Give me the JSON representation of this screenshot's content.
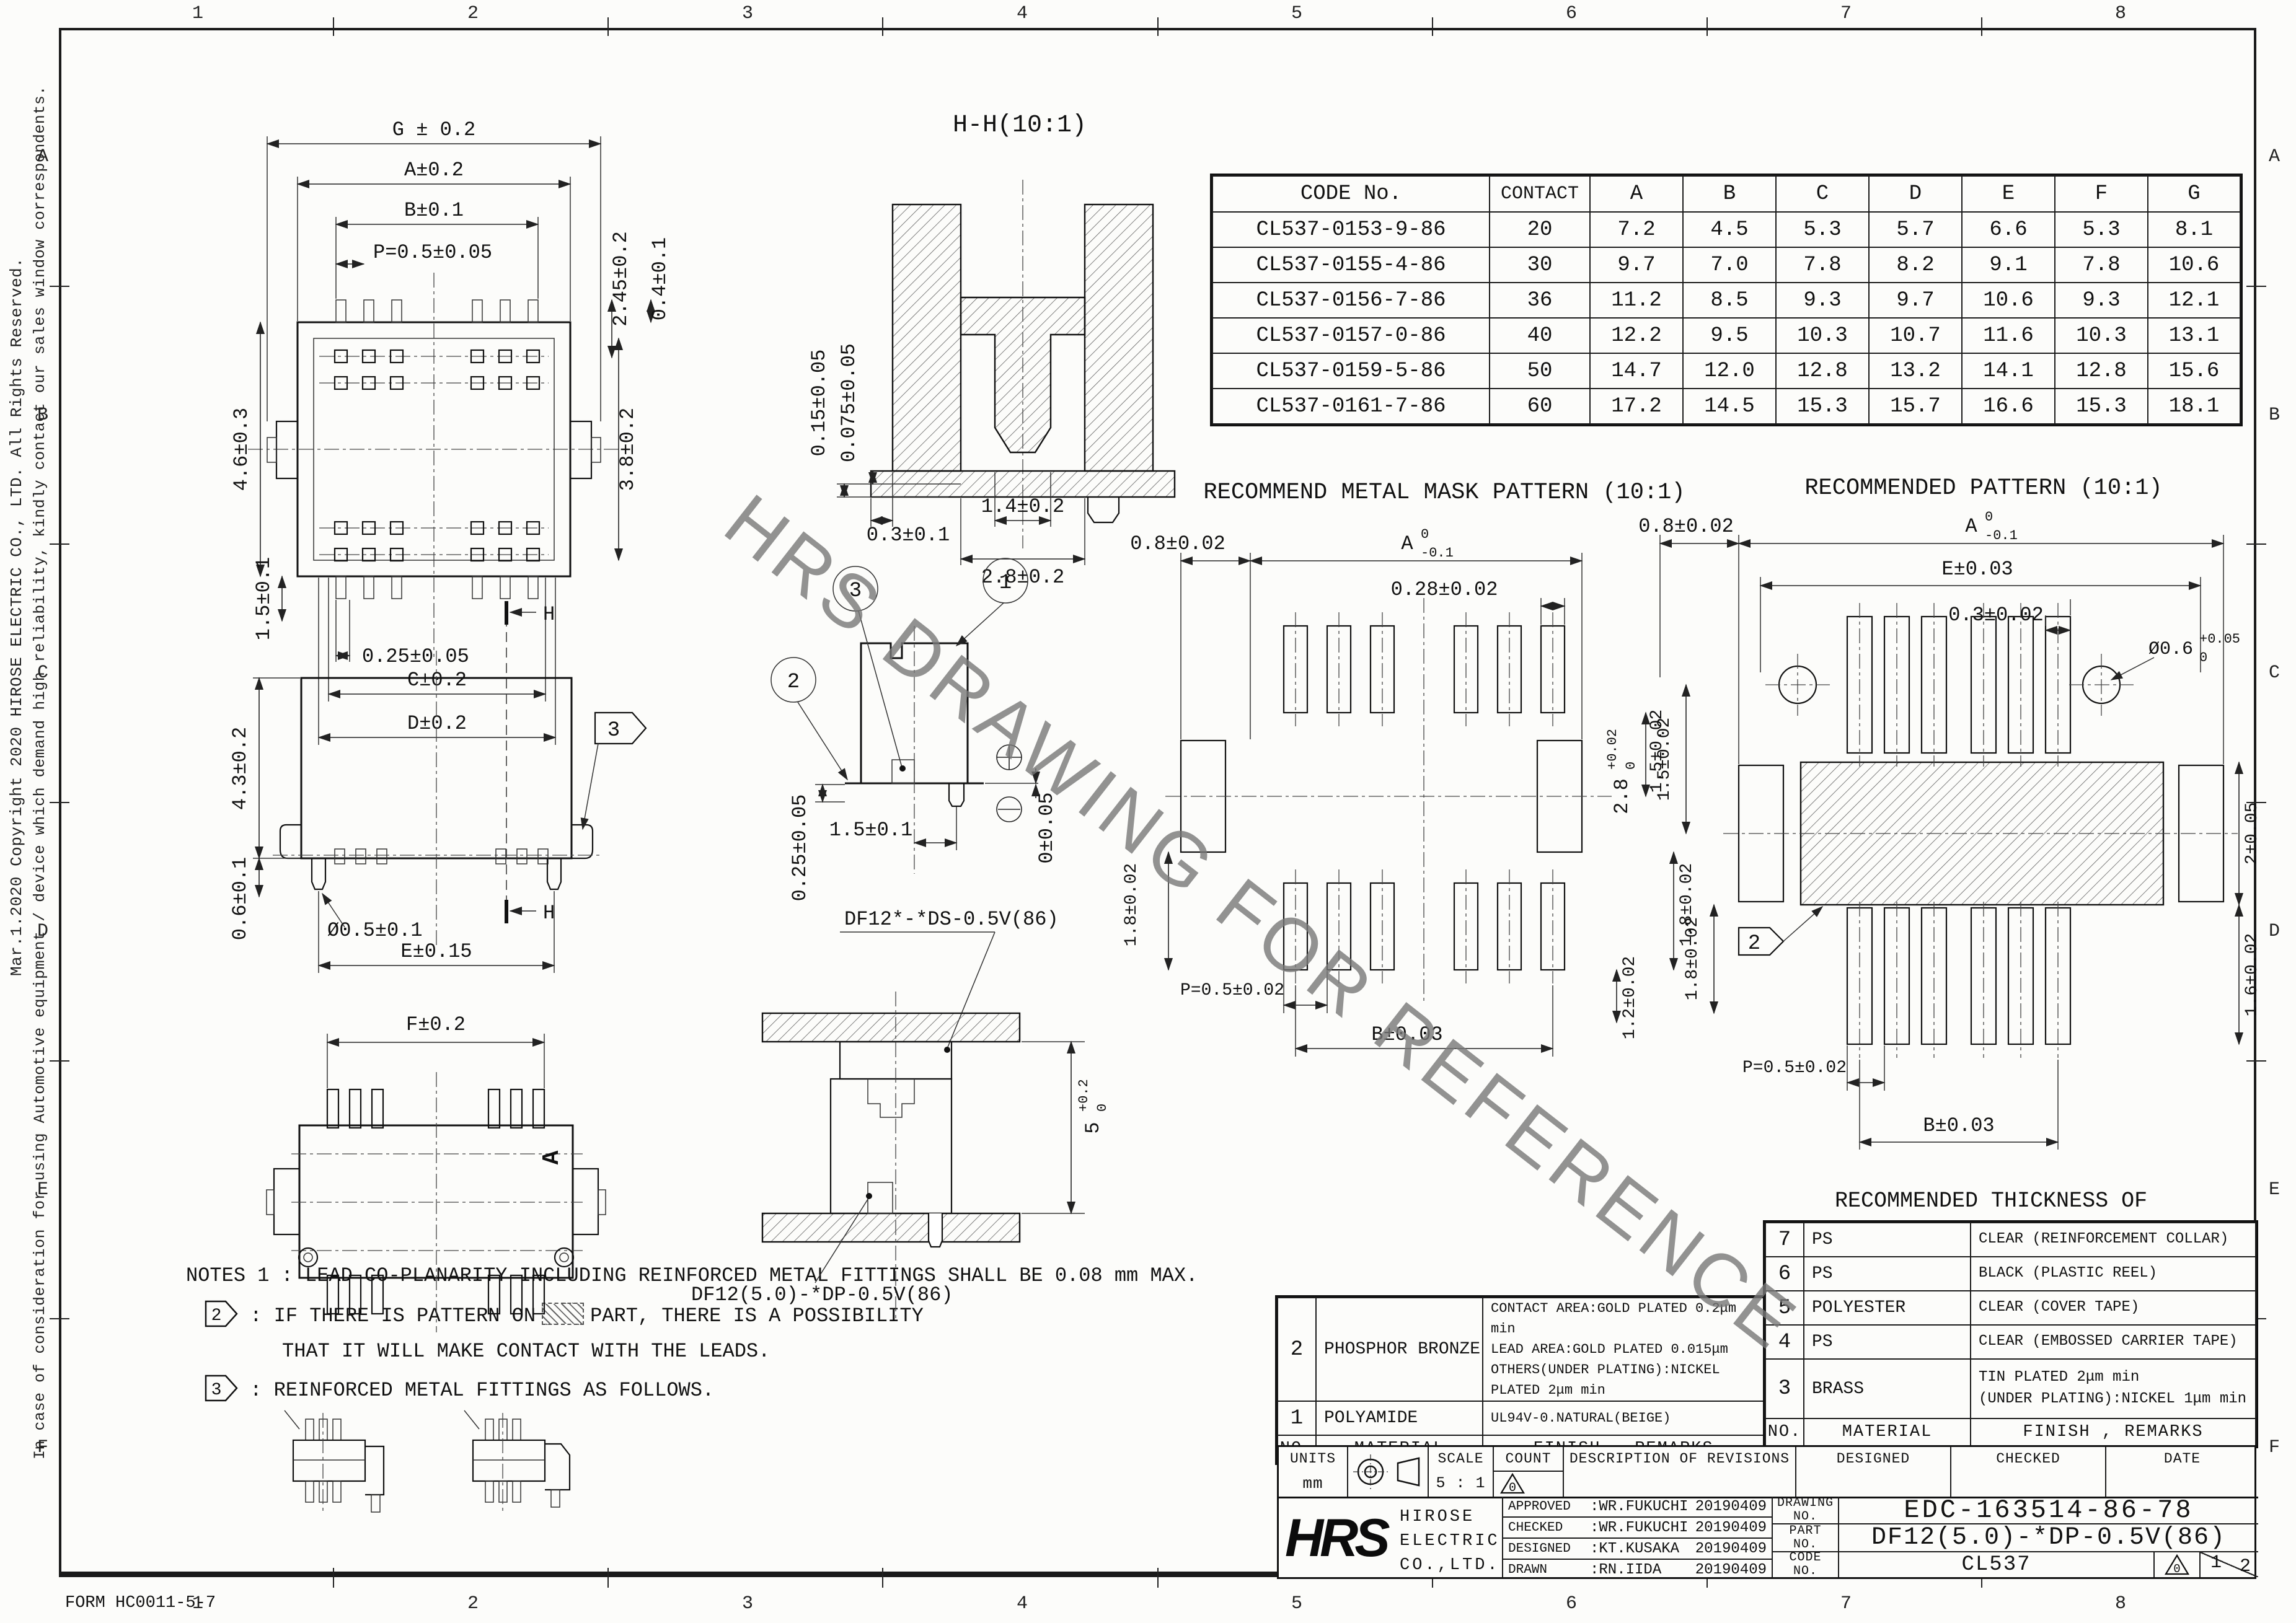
{
  "meta": {
    "watermark": "HRS DRAWING FOR REFERENCE",
    "form_no": "FORM HC0011-5-7",
    "copyright_line": "Mar.1.2020 Copyright 2020 HIROSE ELECTRIC CO., LTD. All Rights Reserved.",
    "caution_line": "In case of consideration for using Automotive equipment / device which demand high reliability, kindly contact our sales window correspondents.",
    "grid_cols": [
      "1",
      "2",
      "3",
      "4",
      "5",
      "6",
      "7",
      "8"
    ],
    "grid_rows": [
      "A",
      "B",
      "C",
      "D",
      "E",
      "F"
    ]
  },
  "code_table": {
    "headers": [
      "CODE No.",
      "CONTACT",
      "A",
      "B",
      "C",
      "D",
      "E",
      "F",
      "G"
    ],
    "rows": [
      [
        "CL537-0153-9-86",
        "20",
        "7.2",
        "4.5",
        "5.3",
        "5.7",
        "6.6",
        "5.3",
        "8.1"
      ],
      [
        "CL537-0155-4-86",
        "30",
        "9.7",
        "7.0",
        "7.8",
        "8.2",
        "9.1",
        "7.8",
        "10.6"
      ],
      [
        "CL537-0156-7-86",
        "36",
        "11.2",
        "8.5",
        "9.3",
        "9.7",
        "10.6",
        "9.3",
        "12.1"
      ],
      [
        "CL537-0157-0-86",
        "40",
        "12.2",
        "9.5",
        "10.3",
        "10.7",
        "11.6",
        "10.3",
        "13.1"
      ],
      [
        "CL537-0159-5-86",
        "50",
        "14.7",
        "12.0",
        "12.8",
        "13.2",
        "14.1",
        "12.8",
        "15.6"
      ],
      [
        "CL537-0161-7-86",
        "60",
        "17.2",
        "14.5",
        "15.3",
        "15.7",
        "16.6",
        "15.3",
        "18.1"
      ]
    ]
  },
  "plan": {
    "dim_g": "G ± 0.2",
    "dim_a": "A±0.2",
    "dim_b": "B±0.1",
    "dim_p": "P=0.5±0.05",
    "dim_245": "2.45±0.2",
    "dim_04": "0.4±0.1",
    "dim_46": "4.6±0.3",
    "dim_38": "3.8±0.2",
    "dim_15": "1.5±0.1",
    "dim_025": "0.25±0.05",
    "dim_c": "C±0.2",
    "dim_d": "D±0.2"
  },
  "section": {
    "title": "H-H(10:1)",
    "dim_015": "0.15±0.05",
    "dim_0075": "0.075±0.05",
    "dim_03": "0.3±0.1",
    "dim_14": "1.4±0.2",
    "dim_28": "2.8±0.2"
  },
  "side": {
    "dim_43": "4.3±0.2",
    "dim_06": "0.6±0.1",
    "dim_dia": "Ø0.5±0.1",
    "dim_e": "E±0.15",
    "h_mark": "H",
    "callout": "3"
  },
  "detail": {
    "b1": "1",
    "b2": "2",
    "b3": "3",
    "dim_025": "0.25±0.05",
    "dim_15": "1.5±0.1",
    "dim_0": "0±0.05"
  },
  "mask": {
    "title": "RECOMMEND METAL MASK PATTERN (10:1)",
    "dim_08": "0.8±0.02",
    "a_base": "A",
    "a_up": "0",
    "a_low": "-0.1",
    "dim_028": "0.28±0.02",
    "dim_15": "1.5±0.02",
    "d28_base": "2.8",
    "d28_up": "+0.02",
    "d28_low": "0",
    "dim_18l": "1.8±0.02",
    "dim_18r": "1.8±0.02",
    "dim_12": "1.2±0.02",
    "dim_p": "P=0.5±0.02",
    "dim_b": "B±0.03"
  },
  "rec": {
    "title": "RECOMMENDED PATTERN (10:1)",
    "dim_08": "0.8±0.02",
    "a_base": "A",
    "a_up": "0",
    "a_low": "-0.1",
    "dim_e": "E±0.03",
    "dim_03": "0.3±0.02",
    "dia_base": "Ø0.6",
    "dia_up": "+0.05",
    "dia_low": "0",
    "dim_2": "2±0.05",
    "dim_16": "1.6±0.02",
    "dim_15": "1.5±0.02",
    "dim_18": "1.8±0.02",
    "dim_p": "P=0.5±0.02",
    "dim_b": "B±0.03",
    "callout": "2",
    "solder1": "RECOMMENDED THICKNESS OF",
    "solder2": "SOLDER PASTE : 120 μm"
  },
  "fview": {
    "dim_f": "F±0.2",
    "marker_a": "A"
  },
  "mated": {
    "label_top": "DF12*-*DS-0.5V(86)",
    "label_bottom": "DF12(5.0)-*DP-0.5V(86)",
    "d5_base": "5",
    "d5_up": "+0.2",
    "d5_low": "0"
  },
  "notes": {
    "line1": "NOTES 1  : LEAD CO-PLANARITY INCLUDING REINFORCED METAL FITTINGS SHALL BE 0.08 mm MAX.",
    "flag2": "2",
    "line2a": ": IF THERE IS PATTERN ON",
    "line2b": "PART, THERE IS A POSSIBILITY",
    "line3": "THAT IT WILL MAKE CONTACT WITH THE LEADS.",
    "flag3": "3",
    "line4": ": REINFORCED METAL FITTINGS AS FOLLOWS."
  },
  "mat_left": {
    "h_no": "NO.",
    "h_mat": "MATERIAL",
    "h_fin": "FINISH , REMARKS",
    "r2_no": "2",
    "r2_mat": "PHOSPHOR BRONZE",
    "r2_f1": "CONTACT AREA:GOLD PLATED 0.2μm min",
    "r2_f2": "LEAD AREA:GOLD PLATED 0.015μm",
    "r2_f3": "OTHERS(UNDER PLATING):NICKEL PLATED 2μm min",
    "r1_no": "1",
    "r1_mat": "POLYAMIDE",
    "r1_f1": "UL94V-0.NATURAL(BEIGE)"
  },
  "mat_right": {
    "h_no": "NO.",
    "h_mat": "MATERIAL",
    "h_fin": "FINISH , REMARKS",
    "r7_no": "7",
    "r7_mat": "PS",
    "r7_f": "CLEAR (REINFORCEMENT COLLAR)",
    "r6_no": "6",
    "r6_mat": "PS",
    "r6_f": "BLACK (PLASTIC REEL)",
    "r5_no": "5",
    "r5_mat": "POLYESTER",
    "r5_f": "CLEAR (COVER TAPE)",
    "r4_no": "4",
    "r4_mat": "PS",
    "r4_f": "CLEAR (EMBOSSED CARRIER TAPE)",
    "r3_no": "3",
    "r3_mat": "BRASS",
    "r3_f1": "TIN PLATED 2μm min",
    "r3_f2": "(UNDER PLATING):NICKEL 1μm min"
  },
  "tb": {
    "units_l": "UNITS",
    "units_v": "mm",
    "scale_l": "SCALE",
    "scale_v": "5 : 1",
    "count_l": "COUNT",
    "rev_l": "DESCRIPTION OF REVISIONS",
    "designed_l": "DESIGNED",
    "checked_l": "CHECKED",
    "date_l": "DATE",
    "rev_mark": "0",
    "logo": "HRS",
    "co1": "HIROSE",
    "co2": "ELECTRIC",
    "co3": "CO.,LTD.",
    "approved_l": "APPROVED",
    "approved_v": ":WR.FUKUCHI",
    "approved_d": "20190409",
    "checked_l2": "CHECKED",
    "checked_v": ":WR.FUKUCHI",
    "checked_d": "20190409",
    "designed_l2": "DESIGNED",
    "designed_v": ":KT.KUSAKA",
    "designed_d": "20190409",
    "drawn_l": "DRAWN",
    "drawn_v": ":RN.IIDA",
    "drawn_d": "20190409",
    "drawing_l": "DRAWING",
    "part_l": "PART",
    "code_l": "CODE",
    "no_l": "NO.",
    "drawing_no": "EDC-163514-86-78",
    "part_no": "DF12(5.0)-*DP-0.5V(86)",
    "code_no": "CL537",
    "page_n": "1",
    "page_d": "2"
  }
}
